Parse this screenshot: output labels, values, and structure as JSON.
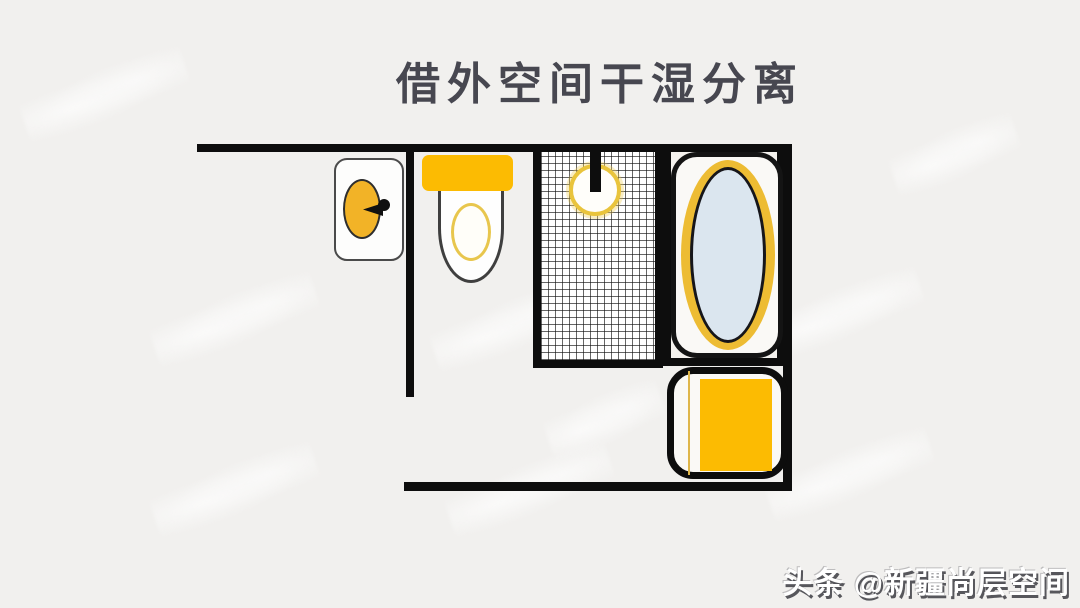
{
  "title": "借外空间干湿分离",
  "credit": "头条 @新疆尚层空间",
  "colors": {
    "background": "#f1f0ee",
    "wall": "#0d0d0d",
    "title_text": "#474750",
    "accent_yellow": "#fcbb02",
    "basin_yellow": "#f2b327",
    "ring_yellow": "#e8c64d",
    "tub_ring_yellow": "#edbc33",
    "tub_water_blue": "#dbe6ef",
    "credit_text": "#ffffff"
  },
  "floorplan": {
    "description": "bathroom floor plan with dry-wet separation using borrowed outside space",
    "fixtures": [
      {
        "name": "washbasin"
      },
      {
        "name": "toilet"
      },
      {
        "name": "shower"
      },
      {
        "name": "bathtub"
      },
      {
        "name": "washing-machine"
      }
    ]
  }
}
